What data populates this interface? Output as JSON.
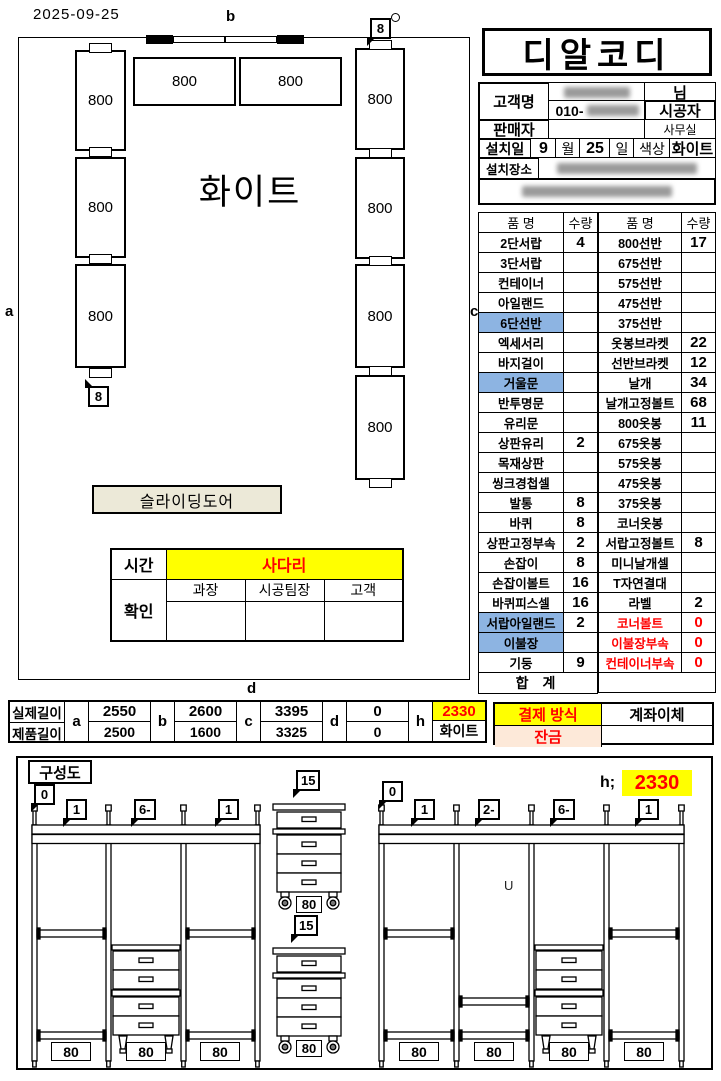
{
  "date": "2025-09-25",
  "colors": {
    "highlight_blue": "#8DB4E2",
    "highlight_yellow": "#FFFF00",
    "alert_red": "#FF0000",
    "balance_peach": "#FDE9D9"
  },
  "plan": {
    "wall_labels": {
      "a": "a",
      "b": "b",
      "c": "c",
      "d": "d"
    },
    "center_text": "화이트",
    "left_boxes": [
      "800",
      "800",
      "800"
    ],
    "top_boxes": [
      "800",
      "800"
    ],
    "right_boxes": [
      "800",
      "800",
      "800",
      "800"
    ],
    "callout_top": "8",
    "callout_bottom": "8",
    "sliding_door": "슬라이딩도어",
    "check_table": {
      "time_label": "시간",
      "time_value": "사다리",
      "confirm_label": "확인",
      "signer_columns": [
        "과장",
        "시공팀장",
        "고객"
      ]
    }
  },
  "header": {
    "company": "디알코디",
    "customer_label": "고객명",
    "name_suffix": "님",
    "phone_prefix": "010-",
    "installer_label": "시공자",
    "seller_label": "판매자",
    "office_label": "사무실",
    "install_label": "설치일",
    "install_month": "9",
    "month_unit": "월",
    "install_day": "25",
    "day_unit": "일",
    "color_label": "색상",
    "color_value": "화이트",
    "place_label": "설치장소"
  },
  "items_left": {
    "headers": [
      "품 명",
      "수량"
    ],
    "rows": [
      {
        "name": "2단서랍",
        "qty": "4"
      },
      {
        "name": "3단서랍",
        "qty": ""
      },
      {
        "name": "컨테이너",
        "qty": ""
      },
      {
        "name": "아일랜드",
        "qty": ""
      },
      {
        "name": "6단선반",
        "qty": "",
        "hl": true
      },
      {
        "name": "엑세서리",
        "qty": ""
      },
      {
        "name": "바지걸이",
        "qty": ""
      },
      {
        "name": "거울문",
        "qty": "",
        "hl": true
      },
      {
        "name": "반투명문",
        "qty": ""
      },
      {
        "name": "유리문",
        "qty": ""
      },
      {
        "name": "상판유리",
        "qty": "2"
      },
      {
        "name": "목재상판",
        "qty": ""
      },
      {
        "name": "씽크경첩셀",
        "qty": ""
      },
      {
        "name": "발통",
        "qty": "8"
      },
      {
        "name": "바퀴",
        "qty": "8"
      },
      {
        "name": "상판고정부속",
        "qty": "2"
      },
      {
        "name": "손잡이",
        "qty": "8"
      },
      {
        "name": "손잡이볼트",
        "qty": "16"
      },
      {
        "name": "바퀴피스셀",
        "qty": "16"
      },
      {
        "name": "서랍아일랜드",
        "qty": "2",
        "hl": true
      },
      {
        "name": "이불장",
        "qty": "",
        "hl": true
      },
      {
        "name": "기둥",
        "qty": "9"
      }
    ],
    "total_label": "합 계"
  },
  "items_right": {
    "headers": [
      "품 명",
      "수량"
    ],
    "rows": [
      {
        "name": "800선반",
        "qty": "17"
      },
      {
        "name": "675선반",
        "qty": ""
      },
      {
        "name": "575선반",
        "qty": ""
      },
      {
        "name": "475선반",
        "qty": ""
      },
      {
        "name": "375선반",
        "qty": ""
      },
      {
        "name": "옷봉브라켓",
        "qty": "22"
      },
      {
        "name": "선반브라켓",
        "qty": "12"
      },
      {
        "name": "날개",
        "qty": "34"
      },
      {
        "name": "날개고정볼트",
        "qty": "68"
      },
      {
        "name": "800옷봉",
        "qty": "11"
      },
      {
        "name": "675옷봉",
        "qty": ""
      },
      {
        "name": "575옷봉",
        "qty": ""
      },
      {
        "name": "475옷봉",
        "qty": ""
      },
      {
        "name": "375옷봉",
        "qty": ""
      },
      {
        "name": "코너옷봉",
        "qty": ""
      },
      {
        "name": "서랍고정볼트",
        "qty": "8"
      },
      {
        "name": "미니날개셀",
        "qty": ""
      },
      {
        "name": "T자연결대",
        "qty": ""
      },
      {
        "name": "라벨",
        "qty": "2"
      },
      {
        "name": "코너볼트",
        "qty": "0",
        "red": true
      },
      {
        "name": "이불장부속",
        "qty": "0",
        "red": true
      },
      {
        "name": "컨테이너부속",
        "qty": "0",
        "red": true
      }
    ]
  },
  "lengths": {
    "row_labels": [
      "실제길이",
      "제품길이"
    ],
    "cols": [
      {
        "key": "a",
        "top": "2550",
        "bottom": "2500"
      },
      {
        "key": "b",
        "top": "2600",
        "bottom": "1600"
      },
      {
        "key": "c",
        "top": "3395",
        "bottom": "3325"
      },
      {
        "key": "d",
        "top": "0",
        "bottom": "0"
      },
      {
        "key": "h",
        "top": "2330",
        "bottom": "화이트",
        "highlight": true
      }
    ]
  },
  "payment": {
    "method_label": "결제 방식",
    "method_value": "계좌이체",
    "balance_label": "잔금",
    "balance_value": ""
  },
  "composition": {
    "title": "구성도",
    "left_callouts": [
      "0",
      "1",
      "6-",
      "1"
    ],
    "right_callouts": [
      "0",
      "1",
      "2-",
      "6-",
      "1"
    ],
    "unit_callout": "15",
    "bay_label": "80",
    "height_label": "h;",
    "height_value": "2330",
    "u_mark": "U"
  }
}
